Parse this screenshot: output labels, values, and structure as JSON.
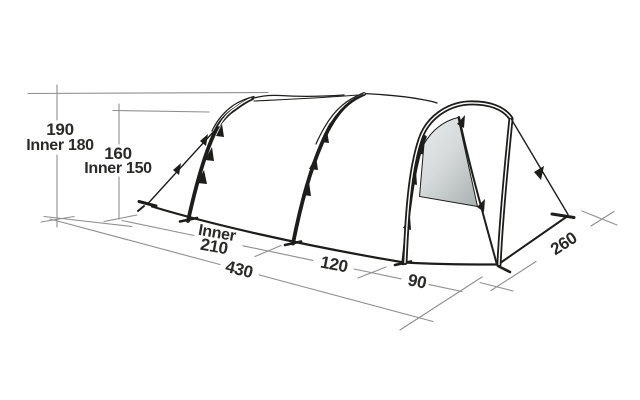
{
  "diagram": {
    "type": "tent-dimension-diagram",
    "labels": {
      "height_outer": "190",
      "height_inner": "Inner 180",
      "mid_height_outer": "160",
      "mid_height_inner": "Inner 150",
      "inner_word": "Inner",
      "inner_length": "210",
      "total_length": "430",
      "segment_mid": "120",
      "segment_front": "90",
      "width": "260"
    },
    "colors": {
      "line": "#1d1d1b",
      "dimension_line": "#8f8f8f",
      "text": "#2a2a28",
      "door_panel_light": "#e8eaea",
      "door_panel_dark": "#adb4b4",
      "background": "#ffffff"
    }
  }
}
